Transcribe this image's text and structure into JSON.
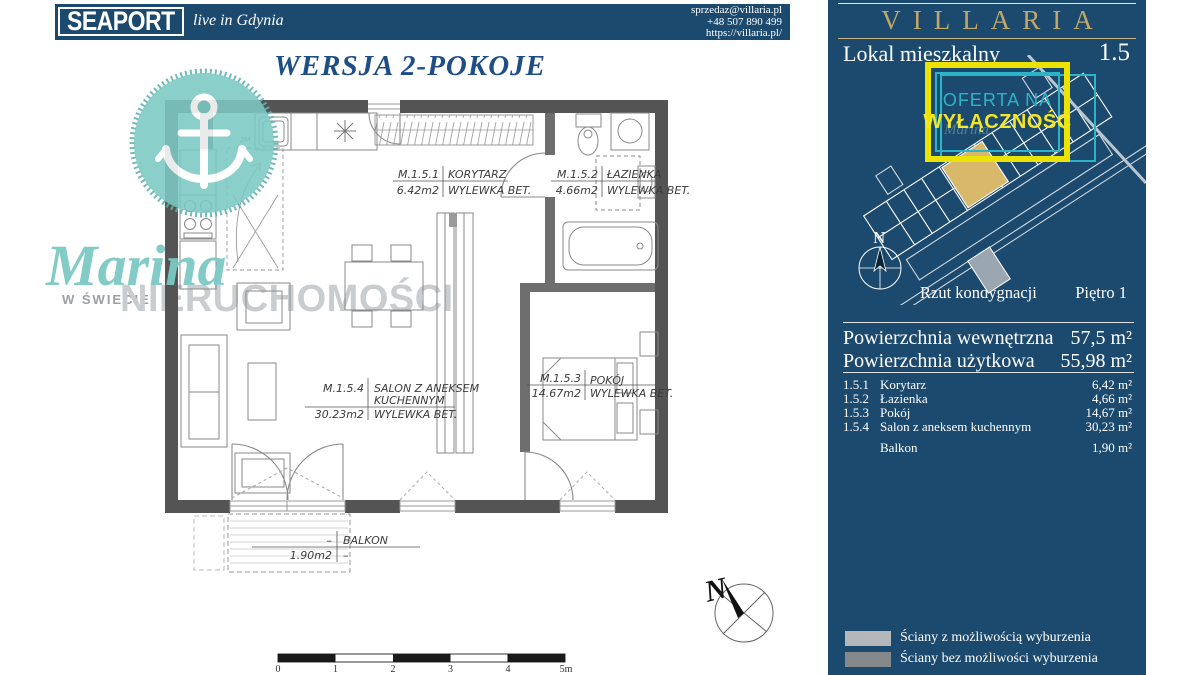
{
  "topbar": {
    "brand": "SEAPORT",
    "tagline": "live in Gdynia",
    "contact_lines": [
      "sprzedaz@villaria.pl",
      "+48 507 890 499",
      "https://villaria.pl/"
    ]
  },
  "main": {
    "title": "WERSJA 2-POKOJE",
    "watermark": {
      "name": "Marina",
      "sub": "W ŚWIECIE",
      "sub2": "NIERUCHOMOŚCI"
    },
    "plan_labels": {
      "korytarz": {
        "code": "M.1.5.1",
        "name": "KORYTARZ",
        "area": "6.42m2",
        "floor": "WYLEWKA BET."
      },
      "lazienka": {
        "code": "M.1.5.2",
        "name": "ŁAZIENKA",
        "area": "4.66m2",
        "floor": "WYLEWKA BET."
      },
      "pokoj": {
        "code": "M.1.5.3",
        "name": "POKÓJ",
        "area": "14.67m2",
        "floor": "WYLEWKA BET."
      },
      "salon": {
        "code": "M.1.5.4",
        "name": "SALON Z ANEKSEM",
        "name2": "KUCHENNYM",
        "area": "30.23m2",
        "floor": "WYLEWKA BET."
      },
      "balkon": {
        "code": "–",
        "name": "BALKON",
        "area": "1.90m2",
        "floor": "–"
      },
      "height_mark": "2M"
    },
    "scalebar": {
      "ticks": [
        "0",
        "1",
        "2",
        "3",
        "4",
        "5m"
      ]
    },
    "compass_label": "N"
  },
  "sidebar": {
    "brand": "VILLARIA",
    "unit_type": "Lokal mieszkalny",
    "unit_number": "1.5",
    "badge": {
      "line1": "OFERTA NA",
      "line2": "WYŁĄCZNOŚĆ"
    },
    "siteplan": {
      "caption": "Rzut kondygnacji",
      "floor": "Piętro 1",
      "compass": "N"
    },
    "areas": {
      "internal_label": "Powierzchnia wewnętrzna",
      "internal_value": "57,5 m²",
      "usable_label": "Powierzchnia użytkowa",
      "usable_value": "55,98 m²",
      "rooms": [
        {
          "no": "1.5.1",
          "name": "Korytarz",
          "value": "6,42 m²"
        },
        {
          "no": "1.5.2",
          "name": "Łazienka",
          "value": "4,66 m²"
        },
        {
          "no": "1.5.3",
          "name": "Pokój",
          "value": "14,67 m²"
        },
        {
          "no": "1.5.4",
          "name": "Salon z aneksem kuchennym",
          "value": "30,23 m²"
        }
      ],
      "balcony_label": "Balkon",
      "balcony_value": "1,90 m²"
    },
    "legend": [
      {
        "label": "Ściany z możliwością wyburzenia"
      },
      {
        "label": "Ściany bez możliwości wyburzenia"
      }
    ]
  },
  "colors": {
    "navy": "#1c4a6e",
    "gold": "#c2a769",
    "teal_badge": "#2cb4c6",
    "yellow_badge": "#ece300",
    "watermark_teal": "#7cc9c4",
    "unit_highlight": "#d8b96b",
    "wall_dark": "#545454",
    "legend_light": "#b4b8bb",
    "legend_dark": "#85898c"
  }
}
